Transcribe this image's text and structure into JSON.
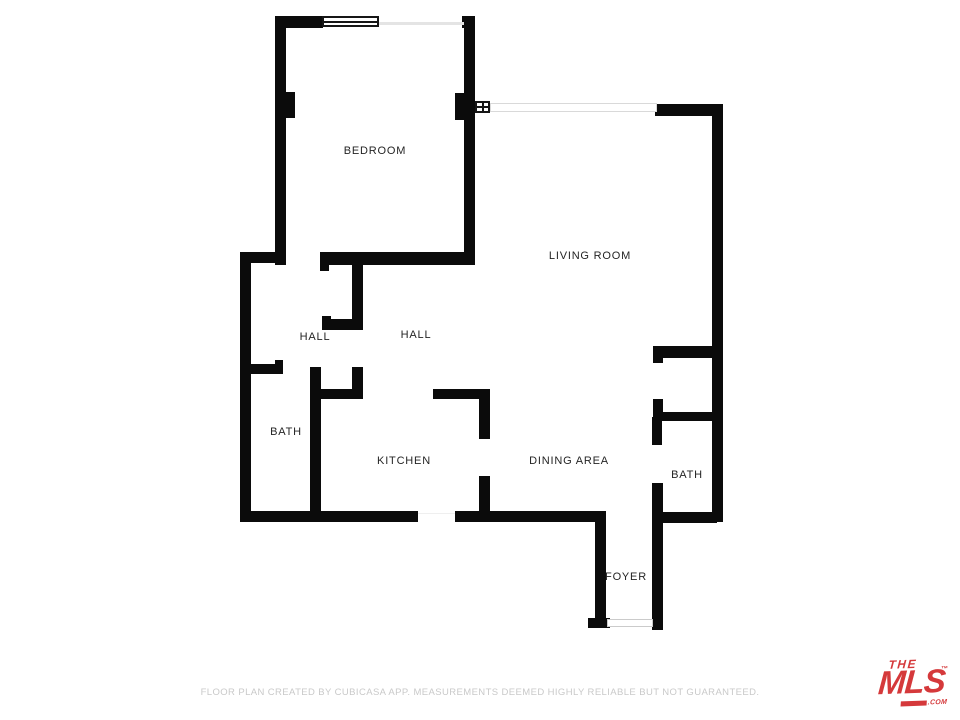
{
  "page": {
    "background": "#ffffff"
  },
  "floorplan": {
    "wall_color": "#0b0b0b",
    "rooms": [
      {
        "id": "bedroom",
        "name": "BEDROOM",
        "x": 375,
        "y": 151
      },
      {
        "id": "living-room",
        "name": "LIVING ROOM",
        "x": 590,
        "y": 256
      },
      {
        "id": "hall-left",
        "name": "HALL",
        "x": 315,
        "y": 337
      },
      {
        "id": "hall-right",
        "name": "HALL",
        "x": 416,
        "y": 335
      },
      {
        "id": "bath-left",
        "name": "BATH",
        "x": 286,
        "y": 432
      },
      {
        "id": "kitchen",
        "name": "KITCHEN",
        "x": 404,
        "y": 461
      },
      {
        "id": "dining-area",
        "name": "DINING AREA",
        "x": 569,
        "y": 461
      },
      {
        "id": "bath-right",
        "name": "BATH",
        "x": 687,
        "y": 475
      },
      {
        "id": "foyer",
        "name": "FOYER",
        "x": 626,
        "y": 577
      }
    ],
    "walls": [
      [
        275,
        16,
        48,
        12
      ],
      [
        275,
        16,
        11,
        249
      ],
      [
        280,
        92,
        15,
        26
      ],
      [
        462,
        16,
        12,
        12
      ],
      [
        464,
        16,
        11,
        249
      ],
      [
        455,
        93,
        20,
        27
      ],
      [
        655,
        104,
        67,
        12
      ],
      [
        712,
        104,
        11,
        418
      ],
      [
        240,
        252,
        11,
        270
      ],
      [
        240,
        252,
        43,
        11
      ],
      [
        320,
        252,
        155,
        13
      ],
      [
        320,
        252,
        9,
        19
      ],
      [
        352,
        255,
        11,
        72
      ],
      [
        322,
        319,
        41,
        11
      ],
      [
        322,
        316,
        9,
        14
      ],
      [
        240,
        364,
        43,
        10
      ],
      [
        275,
        360,
        8,
        14
      ],
      [
        310,
        367,
        11,
        148
      ],
      [
        318,
        389,
        45,
        10
      ],
      [
        352,
        367,
        11,
        32
      ],
      [
        433,
        389,
        56,
        10
      ],
      [
        479,
        389,
        11,
        50
      ],
      [
        479,
        476,
        11,
        46
      ],
      [
        240,
        511,
        178,
        11
      ],
      [
        455,
        511,
        150,
        11
      ],
      [
        595,
        511,
        11,
        117
      ],
      [
        588,
        618,
        22,
        10
      ],
      [
        652,
        483,
        11,
        147
      ],
      [
        653,
        346,
        60,
        12
      ],
      [
        653,
        346,
        10,
        17
      ],
      [
        653,
        399,
        10,
        18
      ],
      [
        656,
        412,
        57,
        9
      ],
      [
        652,
        417,
        10,
        28
      ],
      [
        660,
        512,
        57,
        11
      ]
    ],
    "openings": [
      {
        "kind": "bedroom-window",
        "x": 322,
        "y": 16,
        "w": 57,
        "h": 11,
        "panes": "h"
      },
      {
        "kind": "window-sill-line",
        "x": 379,
        "y": 22,
        "w": 85,
        "h": 3
      },
      {
        "kind": "small-window",
        "x": 475,
        "y": 101,
        "w": 15,
        "h": 12,
        "panes": "hv"
      },
      {
        "kind": "window-band",
        "x": 490,
        "y": 103,
        "w": 167,
        "h": 9
      },
      {
        "kind": "kitchen-opening",
        "x": 418,
        "y": 513,
        "w": 37,
        "h": 6
      },
      {
        "kind": "entry-door",
        "x": 607,
        "y": 619,
        "w": 46,
        "h": 8
      }
    ]
  },
  "footer": {
    "disclaimer": "FLOOR PLAN CREATED BY CUBICASA APP. MEASUREMENTS DEEMED HIGHLY RELIABLE BUT NOT GUARANTEED."
  },
  "logo": {
    "the": "THE",
    "mls": "MLS",
    "com": ".COM",
    "trademark": "™",
    "color": "#d5393b"
  }
}
